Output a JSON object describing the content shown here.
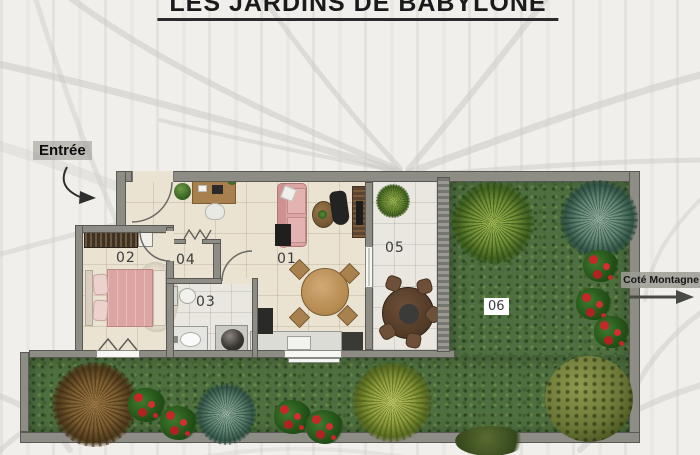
{
  "title": "LES JARDINS DE BABYLONE",
  "entrance": {
    "label": "Entrée"
  },
  "mountain_side": {
    "label": "Coté Montagne"
  },
  "rooms": {
    "r01": "01",
    "r02": "02",
    "r03": "03",
    "r04": "04",
    "r05": "05",
    "r06": "06"
  },
  "colors": {
    "wall": "#8d8d86",
    "floor": "#eae3d1",
    "bath_floor": "#e9e7df",
    "grass": "#4e7040",
    "pink": "#dca4a2",
    "wood": "#a8804e",
    "dark_wood": "#5d4430",
    "flower_red": "#c62828",
    "label_ink": "#3b3b3b",
    "title_ink": "#1a1a1a"
  }
}
